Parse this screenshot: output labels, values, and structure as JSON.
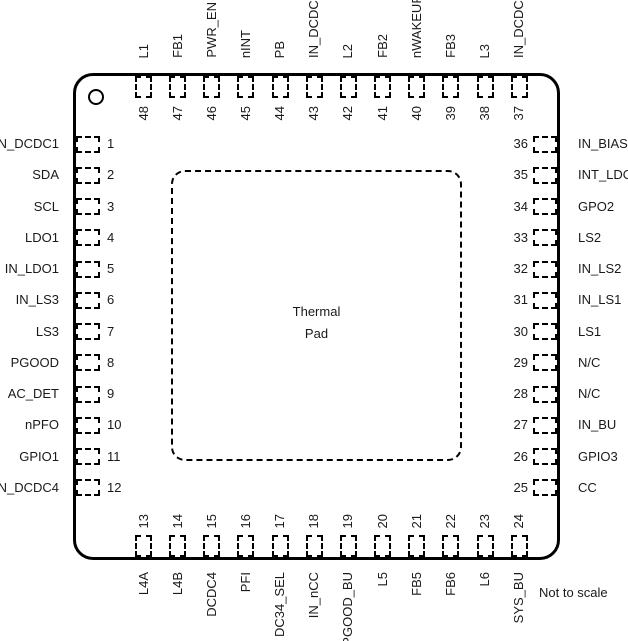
{
  "figure": {
    "thermal_pad": {
      "line1": "Thermal",
      "line2": "Pad"
    },
    "note": "Not to scale"
  },
  "pins": {
    "left": [
      {
        "num": "1",
        "label": "IN_DCDC1"
      },
      {
        "num": "2",
        "label": "SDA"
      },
      {
        "num": "3",
        "label": "SCL"
      },
      {
        "num": "4",
        "label": "LDO1"
      },
      {
        "num": "5",
        "label": "IN_LDO1"
      },
      {
        "num": "6",
        "label": "IN_LS3"
      },
      {
        "num": "7",
        "label": "LS3"
      },
      {
        "num": "8",
        "label": "PGOOD"
      },
      {
        "num": "9",
        "label": "AC_DET"
      },
      {
        "num": "10",
        "label": "nPFO"
      },
      {
        "num": "11",
        "label": "GPIO1"
      },
      {
        "num": "12",
        "label": "IN_DCDC4"
      }
    ],
    "top": [
      {
        "num": "48",
        "label": "L1"
      },
      {
        "num": "47",
        "label": "FB1"
      },
      {
        "num": "46",
        "label": "PWR_EN"
      },
      {
        "num": "45",
        "label": "nINT"
      },
      {
        "num": "44",
        "label": "PB"
      },
      {
        "num": "43",
        "label": "IN_DCDC2"
      },
      {
        "num": "42",
        "label": "L2"
      },
      {
        "num": "41",
        "label": "FB2"
      },
      {
        "num": "40",
        "label": "nWAKEUP"
      },
      {
        "num": "39",
        "label": "FB3"
      },
      {
        "num": "38",
        "label": "L3"
      },
      {
        "num": "37",
        "label": "IN_DCDC3"
      }
    ],
    "right": [
      {
        "num": "36",
        "label": "IN_BIAS"
      },
      {
        "num": "35",
        "label": "INT_LDO"
      },
      {
        "num": "34",
        "label": "GPO2"
      },
      {
        "num": "33",
        "label": "LS2"
      },
      {
        "num": "32",
        "label": "IN_LS2"
      },
      {
        "num": "31",
        "label": "IN_LS1"
      },
      {
        "num": "30",
        "label": "LS1"
      },
      {
        "num": "29",
        "label": "N/C"
      },
      {
        "num": "28",
        "label": "N/C"
      },
      {
        "num": "27",
        "label": "IN_BU"
      },
      {
        "num": "26",
        "label": "GPIO3"
      },
      {
        "num": "25",
        "label": "CC"
      }
    ],
    "bottom": [
      {
        "num": "13",
        "label": "L4A"
      },
      {
        "num": "14",
        "label": "L4B"
      },
      {
        "num": "15",
        "label": "DCDC4"
      },
      {
        "num": "16",
        "label": "PFI"
      },
      {
        "num": "17",
        "label": "DC34_SEL"
      },
      {
        "num": "18",
        "label": "IN_nCC"
      },
      {
        "num": "19",
        "label": "PGOOD_BU"
      },
      {
        "num": "20",
        "label": "L5"
      },
      {
        "num": "21",
        "label": "FB5"
      },
      {
        "num": "22",
        "label": "FB6"
      },
      {
        "num": "23",
        "label": "L6"
      },
      {
        "num": "24",
        "label": "SYS_BU"
      }
    ]
  }
}
